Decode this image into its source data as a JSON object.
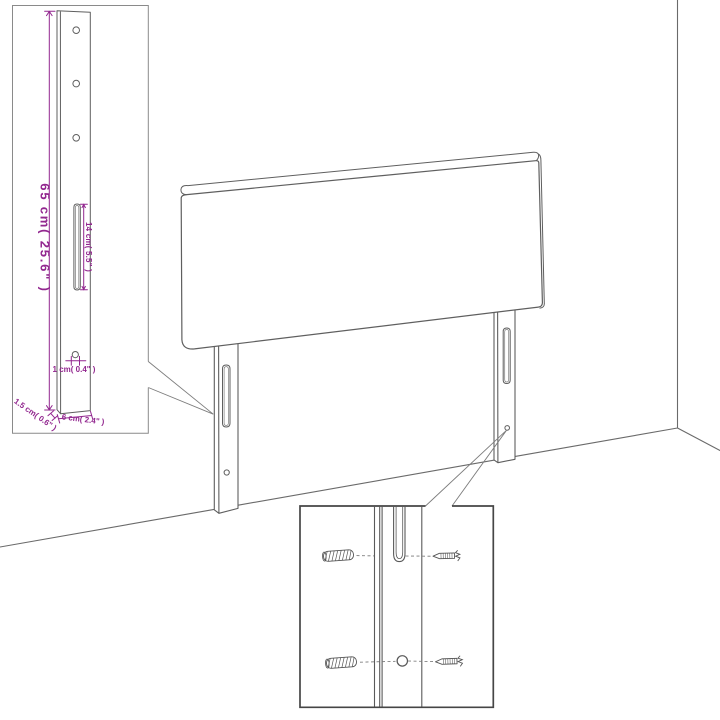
{
  "diagram": {
    "background": "#ffffff",
    "accent_color": "#92278F",
    "line_color": "#5f5f5f",
    "icons": [
      "headboard-drawing",
      "leg-post-detail",
      "mounting-hardware-detail",
      "wall-plug-icon",
      "screw-icon"
    ]
  },
  "left_detail": {
    "height_label": "65 cm( 25.6\" )",
    "slot_label": "14 cm( 5.5\" )",
    "hole_label": "1 cm( 0.4\" )",
    "depth_label": "1.5 cm( 0.6\" )",
    "width_label": "6 cm( 2.4\" )"
  }
}
